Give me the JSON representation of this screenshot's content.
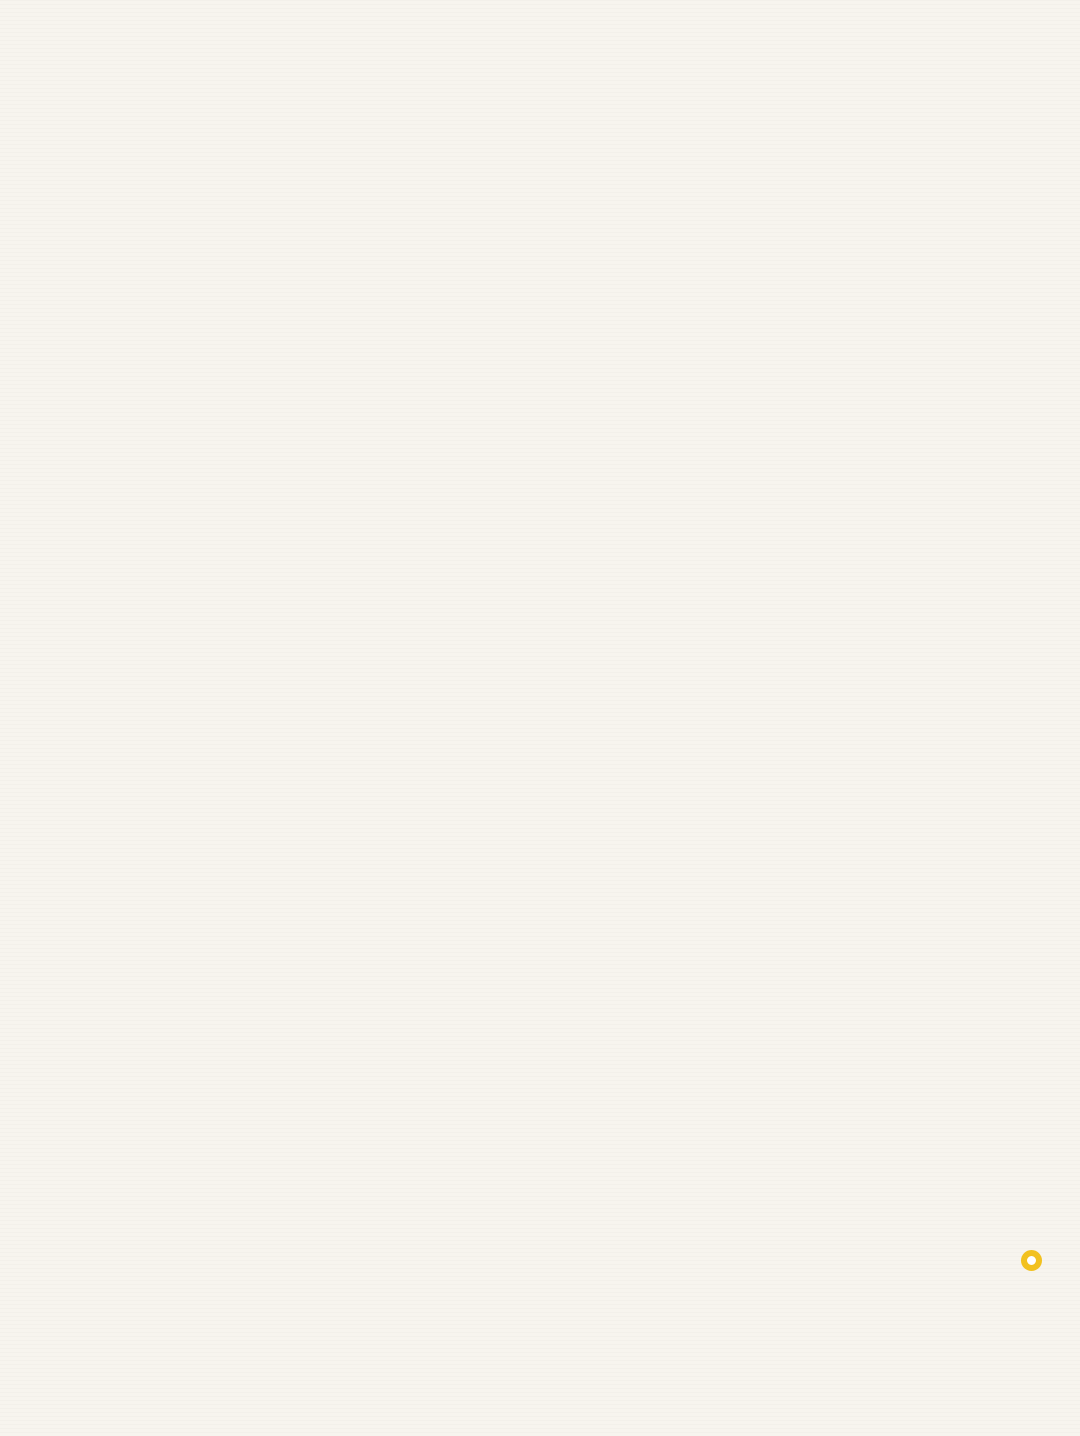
{
  "page": {
    "background": "#f7f4ee"
  },
  "header": {
    "title_main": "长安城六街",
    "title_sub": "示意",
    "title_color": "#b5735a",
    "reference": "参考文献： 王才强. 唐长安的数码重建[M]. 中国建筑工业出版社， 2006."
  },
  "map": {
    "palette": {
      "street": "#e3d8b9",
      "ward": "#d3c5a0",
      "plain": "#d8caa5",
      "wall_light": "#f3f4f6",
      "wall_shade": "#b9c3d1",
      "ward_line": "#f0f1f3",
      "building": "#f3f4f6",
      "building_edge": "#9fadc4",
      "water": "#7ba3c5",
      "water_dark": "#5e8ab1",
      "gate_label": "#c05a3a",
      "palace_label": "#b2503a"
    },
    "quad": {
      "nw": [
        265,
        472
      ],
      "ne": [
        916,
        545
      ],
      "sw": [
        63,
        957
      ],
      "se": [
        958,
        1105
      ]
    },
    "outline": [
      [
        265,
        472
      ],
      [
        527,
        501
      ],
      [
        527,
        474
      ],
      [
        660,
        489
      ],
      [
        660,
        517
      ],
      [
        673,
        518
      ],
      [
        683,
        433
      ],
      [
        768,
        436
      ],
      [
        781,
        484
      ],
      [
        801,
        481
      ],
      [
        807,
        533
      ],
      [
        916,
        545
      ],
      [
        957,
        1150
      ],
      [
        906,
        1147
      ],
      [
        901,
        1212
      ],
      [
        798,
        1192
      ],
      [
        795,
        1080
      ],
      [
        63,
        957
      ]
    ],
    "grid": {
      "margin": 0.012,
      "verticals": [
        {
          "u": 0.095,
          "w": 0.004
        },
        {
          "u": 0.19,
          "w": 0.004
        },
        {
          "u": 0.3,
          "w": 0.007
        },
        {
          "u": 0.375,
          "w": 0.004
        },
        {
          "u": 0.445,
          "w": 0.011
        },
        {
          "u": 0.525,
          "w": 0.004
        },
        {
          "u": 0.6,
          "w": 0.007
        },
        {
          "u": 0.7,
          "w": 0.004
        },
        {
          "u": 0.8,
          "w": 0.004
        },
        {
          "u": 0.9,
          "w": 0.004
        }
      ],
      "horizontals": [
        {
          "v": 0.14,
          "w": 0.012
        },
        {
          "v": 0.225,
          "w": 0.006
        },
        {
          "v": 0.3,
          "w": 0.012
        },
        {
          "v": 0.385,
          "w": 0.006
        },
        {
          "v": 0.47,
          "w": 0.006
        },
        {
          "v": 0.56,
          "w": 0.012
        },
        {
          "v": 0.645,
          "w": 0.006
        },
        {
          "v": 0.72,
          "w": 0.006
        },
        {
          "v": 0.8,
          "w": 0.006
        },
        {
          "v": 0.875,
          "w": 0.006
        },
        {
          "v": 0.945,
          "w": 0.006
        }
      ]
    },
    "palace_region": {
      "u0": 0.335,
      "v0": 0.005,
      "u1": 0.66,
      "v1": 0.168
    },
    "taiji_bump": [
      [
        527,
        501
      ],
      [
        527,
        474
      ],
      [
        660,
        489
      ],
      [
        660,
        517
      ]
    ],
    "step": [
      [
        660,
        517
      ],
      [
        660,
        499
      ],
      [
        673,
        500
      ],
      [
        673,
        518
      ]
    ],
    "daming": [
      [
        673,
        518
      ],
      [
        683,
        433
      ],
      [
        768,
        436
      ],
      [
        781,
        484
      ],
      [
        801,
        481
      ],
      [
        807,
        533
      ]
    ],
    "daming_stream": "688,455 712,444 738,446 758,452",
    "daming_pond": {
      "cx": 770,
      "cy": 452,
      "rx": 9,
      "ry": 5
    },
    "daming_buildings": [
      [
        700,
        468,
        12,
        8
      ],
      [
        724,
        490,
        14,
        8
      ],
      [
        744,
        464,
        10,
        7
      ],
      [
        758,
        498,
        12,
        8
      ],
      [
        700,
        502,
        10,
        7
      ],
      [
        714,
        458,
        8,
        26
      ]
    ],
    "protrusion": [
      [
        795,
        1080
      ],
      [
        798,
        1192
      ],
      [
        901,
        1212
      ],
      [
        906,
        1147
      ],
      [
        957,
        1150
      ],
      [
        958,
        1105
      ]
    ],
    "lakes": [
      {
        "name": "west-pond",
        "dark": false,
        "d": "M283,650 C287,639 306,633 321,639 C333,632 350,636 355,645 C359,654 348,661 339,658 C331,668 304,670 295,662 C286,661 280,658 283,650 Z"
      },
      {
        "name": "longchi-pool",
        "dark": true,
        "d": "M845,689 C852,679 868,679 882,682 C898,683 908,687 907,693 C902,700 878,700 866,698 C855,700 843,697 845,689 Z"
      },
      {
        "name": "round-pond",
        "dark": false,
        "d": "M779,721 C785,710 805,709 814,717 C821,725 819,737 809,741 C798,746 783,743 778,734 C776,730 776,726 779,721 Z"
      },
      {
        "name": "qujiang-pool",
        "dark": false,
        "d": "M837,1044 C847,1037 861,1040 866,1050 C875,1056 874,1067 868,1074 C880,1083 886,1098 882,1114 C890,1119 889,1130 880,1135 C875,1152 872,1172 864,1188 C858,1201 841,1203 835,1192 C827,1179 824,1159 828,1142 C819,1131 818,1112 824,1098 C816,1085 820,1062 830,1053 C831,1048 833,1046 837,1044 Z"
      }
    ],
    "gates": [
      {
        "name": "开远门",
        "cx": 241,
        "cy": 531,
        "lx": 219,
        "ly": 430
      },
      {
        "name": "金光门",
        "cx": 195,
        "cy": 613,
        "lx": 172,
        "ly": 514
      },
      {
        "name": "延平门",
        "cx": 137,
        "cy": 739,
        "lx": 112,
        "ly": 636
      },
      {
        "name": "光化门",
        "cx": 348,
        "cy": 478,
        "lx": 334,
        "ly": 378
      },
      {
        "name": "景曜门",
        "cx": 418,
        "cy": 484,
        "lx": 404,
        "ly": 386
      },
      {
        "name": "芳林门",
        "cx": 488,
        "cy": 492,
        "lx": 474,
        "ly": 394
      },
      {
        "name": "通化门",
        "cx": 922,
        "cy": 622,
        "lx": 930,
        "ly": 538
      },
      {
        "name": "春明门",
        "cx": 926,
        "cy": 718,
        "lx": 940,
        "ly": 632
      },
      {
        "name": "延兴门",
        "cx": 937,
        "cy": 861,
        "lx": 945,
        "ly": 782
      },
      {
        "name": "安化门",
        "cx": 332,
        "cy": 1005,
        "lx": 316,
        "ly": 1016
      },
      {
        "name": "明德门",
        "cx": 462,
        "cy": 1028,
        "lx": 448,
        "ly": 1040
      },
      {
        "name": "启夏门",
        "cx": 602,
        "cy": 1051,
        "lx": 589,
        "ly": 1062
      }
    ],
    "palace_labels": [
      {
        "name": "太极宫",
        "x": 567,
        "y": 482
      },
      {
        "name": "大明宫",
        "x": 706,
        "y": 437
      }
    ],
    "water_label": {
      "name": "曲江池",
      "x": 838,
      "y": 1078
    }
  },
  "logo": {
    "cn": "星球研究所",
    "en": "INSTITUTE FOR PLANETS",
    "dot_color": "#f2c11f"
  }
}
